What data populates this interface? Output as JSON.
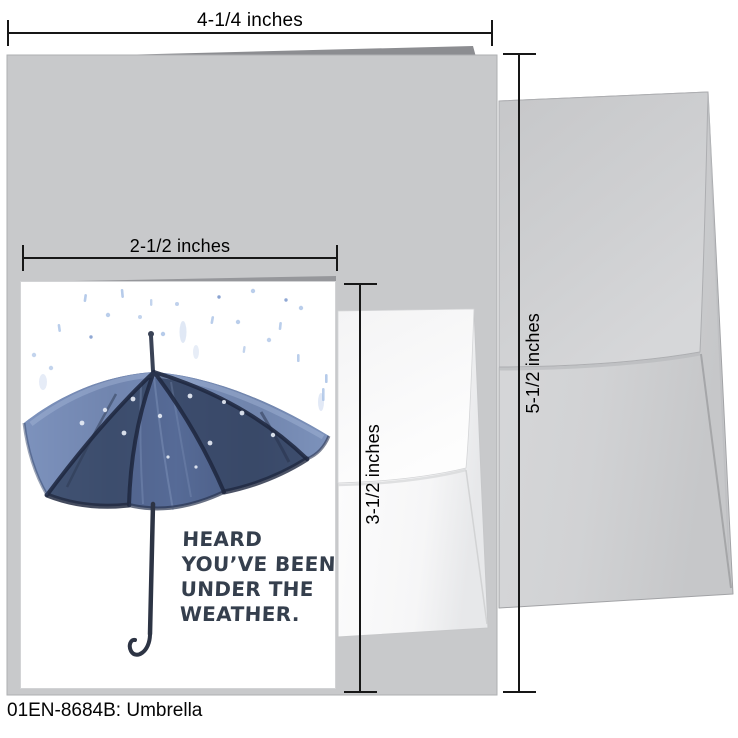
{
  "product": {
    "code_label": "01EN-8684B: Umbrella"
  },
  "dimensions": {
    "card_width": "4-1/4 inches",
    "insert_width": "2-1/2 inches",
    "insert_height": "3-1/2 inches",
    "envelope_height": "5-1/2 inches"
  },
  "card": {
    "message_lines": [
      "HEARD",
      "YOU’VE BEEN",
      "UNDER THE",
      "WEATHER."
    ]
  },
  "colors": {
    "card_back_gray": "#c8c9cb",
    "envelope_large_gray": "#d2d3d5",
    "envelope_small_white": "#fafafb",
    "umbrella_blue": "#5a6f9b",
    "umbrella_rib_navy": "#232c42",
    "rain_light_blue": "#a9c2e6",
    "message_text": "#353f4d",
    "dimension_black": "#171717"
  }
}
